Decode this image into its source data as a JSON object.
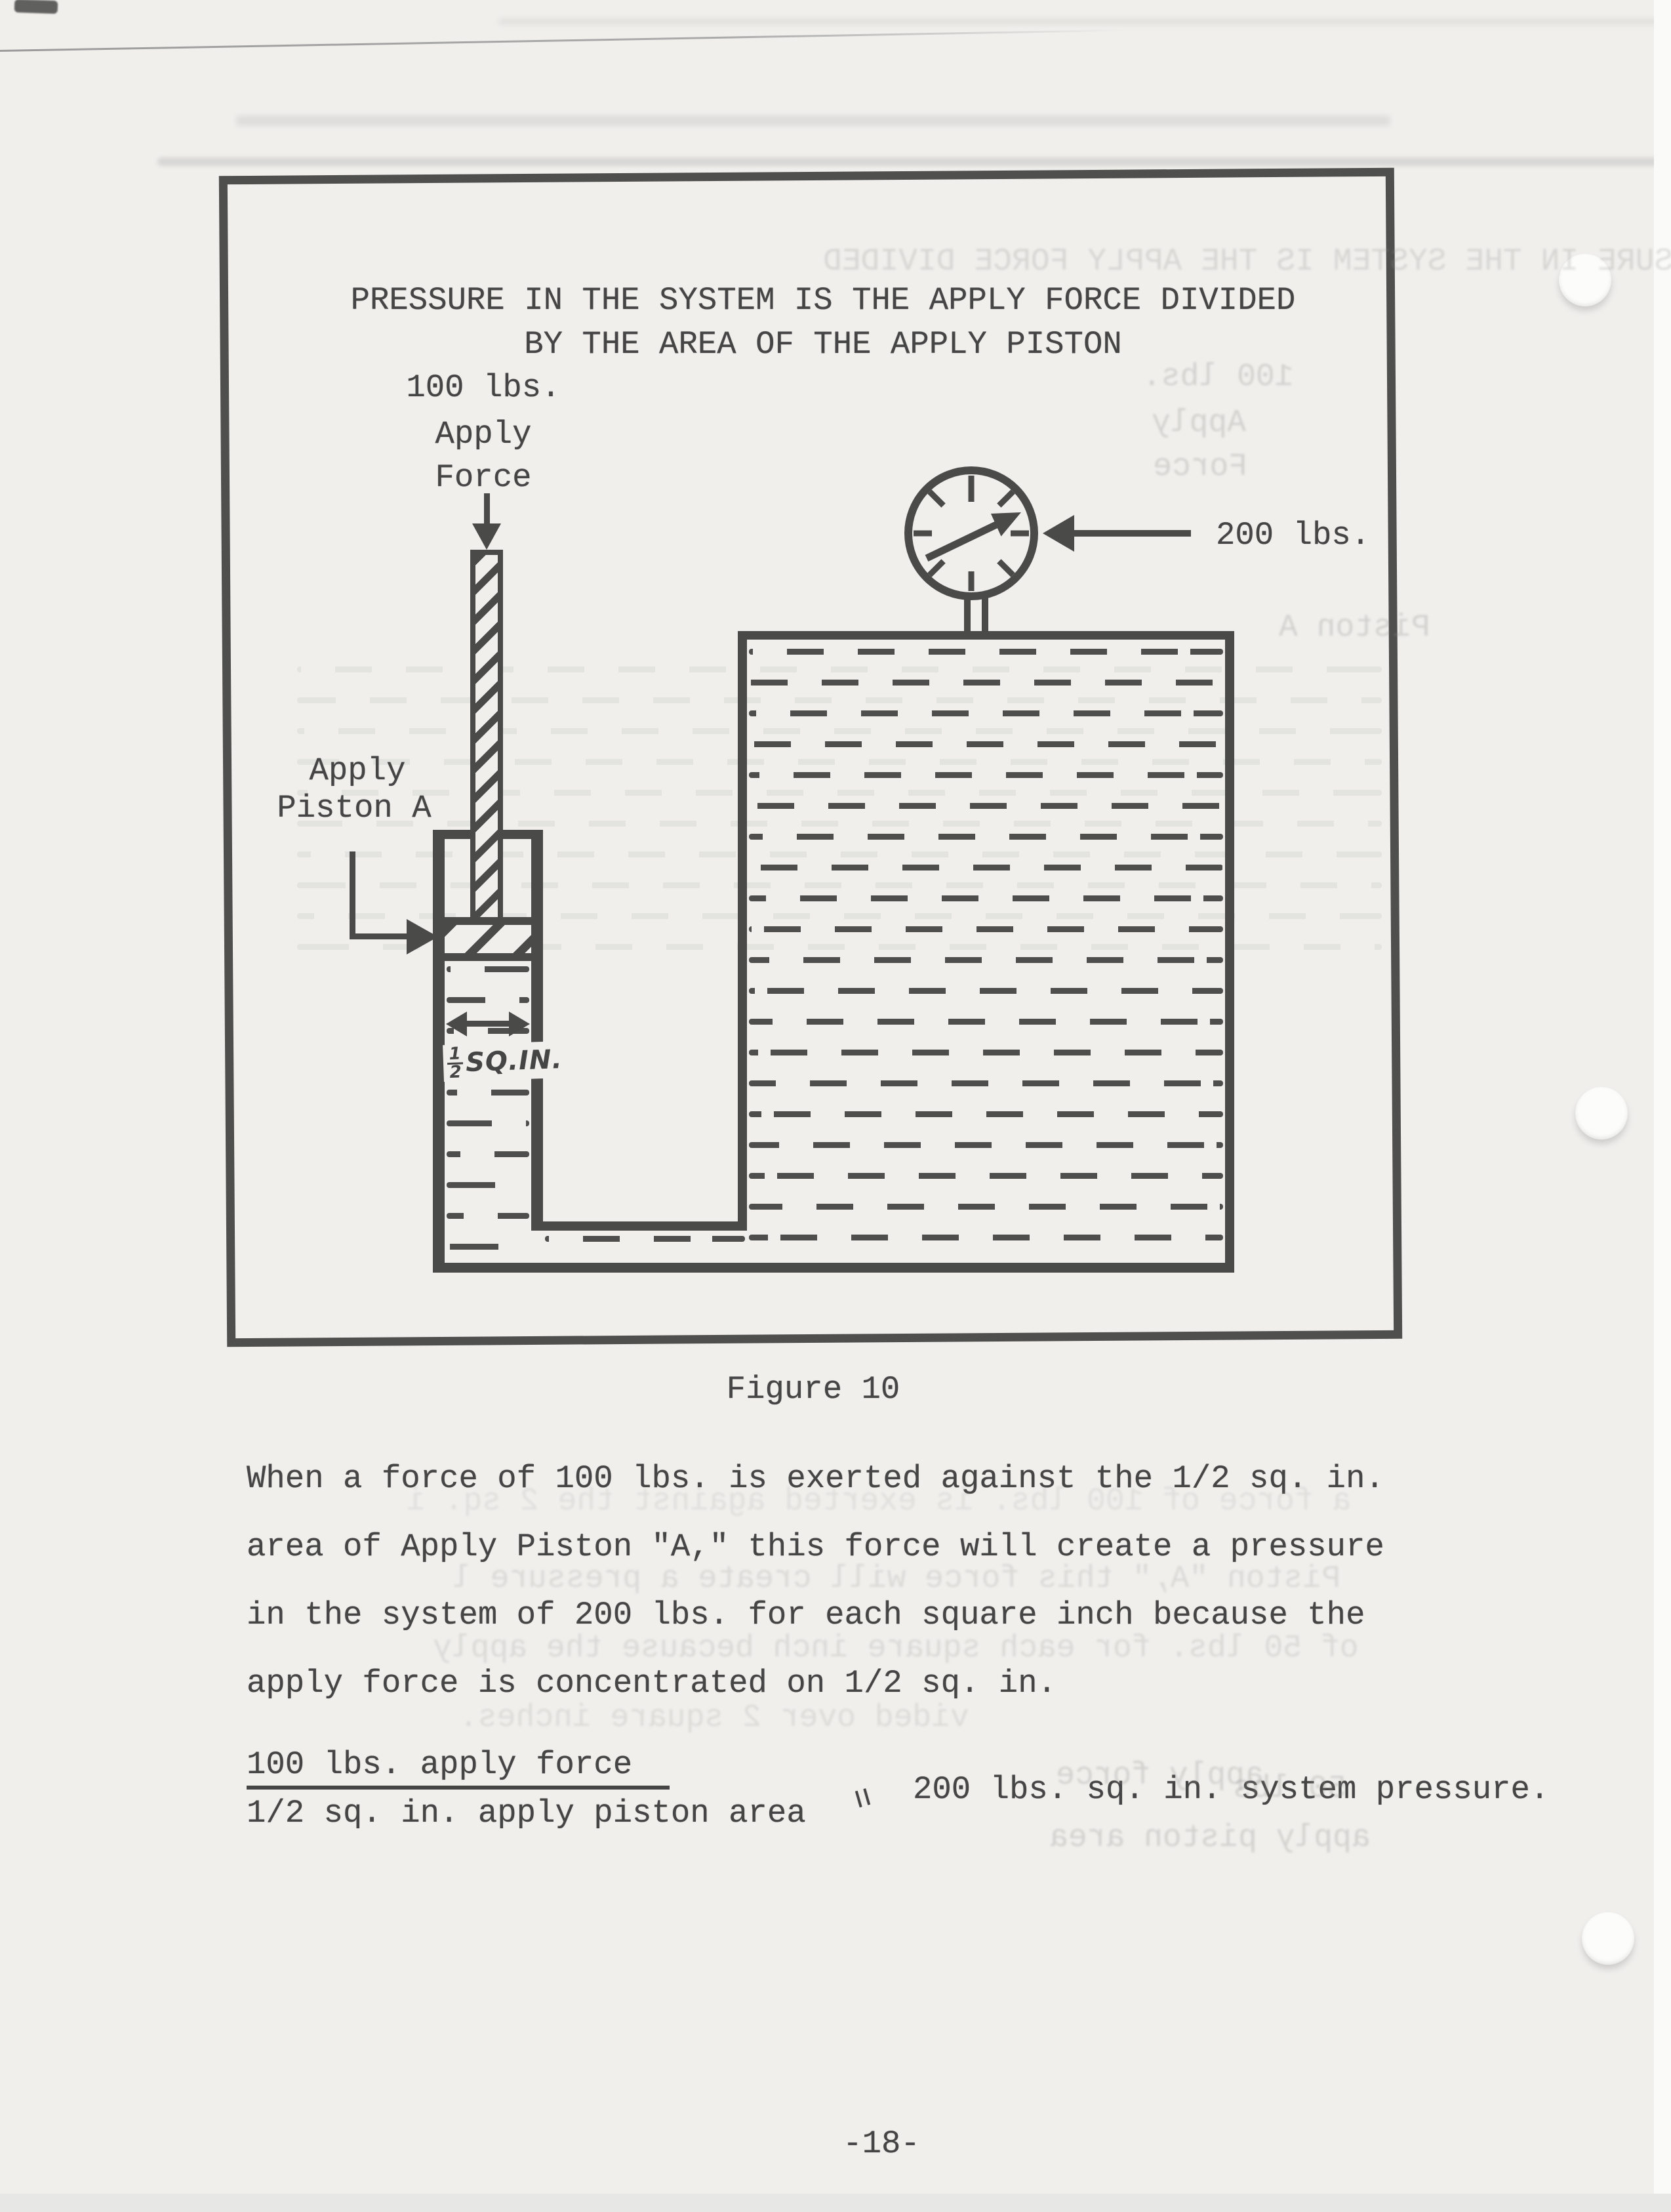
{
  "page": {
    "number_label": "-18-"
  },
  "figure": {
    "caption": "Figure 10",
    "title_line1": "PRESSURE IN THE SYSTEM IS THE APPLY FORCE DIVIDED",
    "title_line2": "BY THE AREA OF THE APPLY PISTON",
    "labels": {
      "apply_force_line1": "100 lbs.",
      "apply_force_line2": "Apply",
      "apply_force_line3": "Force",
      "apply_piston_line1": "Apply",
      "apply_piston_line2": "Piston A",
      "gauge_reading": "200 lbs.",
      "piston_area_numerator": "1",
      "piston_area_denominator": "2",
      "piston_area_unit": "SQ.IN."
    }
  },
  "body_text": {
    "paragraph_lines": [
      "When a force of 100 lbs. is exerted against the 1/2 sq. in.",
      "area of Apply Piston \"A,\" this force will create a pressure",
      "in the system of 200 lbs. for each square inch because the",
      "apply force is concentrated on 1/2 sq. in."
    ],
    "equation": {
      "numerator": "100 lbs. apply force",
      "denominator": "1/2 sq. in. apply piston area",
      "equals": "=",
      "result": "200 lbs. sq. in. system pressure."
    }
  },
  "bleed_through": {
    "title": "PRESSURE IN THE SYSTEM IS THE APPLY FORCE DIVIDED",
    "apply_force_line1": "100 lbs.",
    "apply_force_line2": "Apply",
    "apply_force_line3": "Force",
    "piston_label": "Piston A",
    "after_line1": "a force of 100 lbs. is exerted against the 2 sq. i",
    "after_line2": "Piston \"A,\" this force will create a pressure l",
    "after_line3": "of 50 lbs. for each square inch because the apply",
    "after_line4": "vided over 2 square inches.",
    "eq_numerator": "apply force",
    "eq_result": "50 lbs",
    "eq_denominator": "apply piston area"
  },
  "colors": {
    "ink": "#454545",
    "paper": "#f0efec",
    "line": "#4a4a49"
  }
}
